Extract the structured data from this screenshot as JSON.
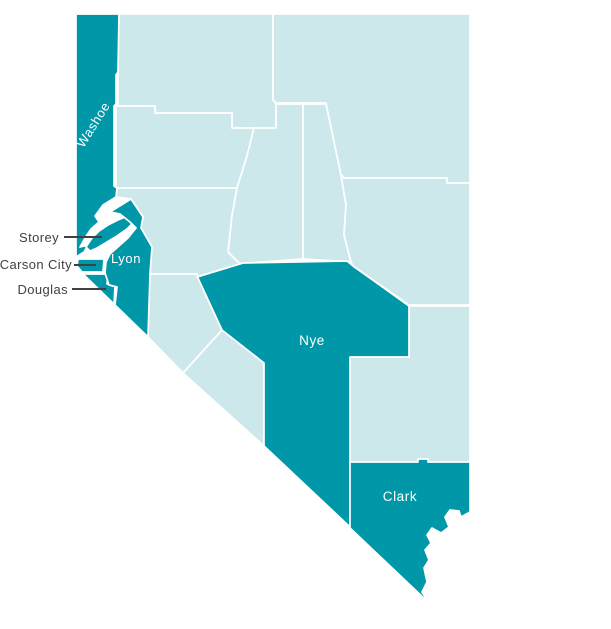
{
  "map": {
    "region": "Nevada",
    "colors": {
      "highlight": "#0097a9",
      "base": "#cde8eb",
      "border": "#ffffff",
      "inside_label": "#ffffff",
      "external_label": "#3e4042",
      "leader_line": "#3e4042",
      "background": "#ffffff"
    },
    "counties": [
      {
        "id": "humboldt",
        "name": "Humboldt",
        "highlighted": false
      },
      {
        "id": "elko",
        "name": "Elko",
        "highlighted": false
      },
      {
        "id": "pershing",
        "name": "Pershing",
        "highlighted": false
      },
      {
        "id": "lander",
        "name": "Lander",
        "highlighted": false
      },
      {
        "id": "eureka",
        "name": "Eureka",
        "highlighted": false
      },
      {
        "id": "white_pine",
        "name": "White Pine",
        "highlighted": false
      },
      {
        "id": "churchill",
        "name": "Churchill",
        "highlighted": false
      },
      {
        "id": "mineral",
        "name": "Mineral",
        "highlighted": false
      },
      {
        "id": "esmeralda",
        "name": "Esmeralda",
        "highlighted": false
      },
      {
        "id": "lincoln",
        "name": "Lincoln",
        "highlighted": false
      },
      {
        "id": "washoe",
        "name": "Washoe",
        "highlighted": true,
        "label": {
          "text": "Washoe",
          "placement": "inside",
          "x": 97,
          "y": 127,
          "rotation": -58,
          "font_size": 13
        }
      },
      {
        "id": "storey",
        "name": "Storey",
        "highlighted": true,
        "label": {
          "text": "Storey",
          "placement": "outside",
          "x": 59,
          "y": 242,
          "font_size": 13,
          "line": [
            64,
            237,
            102,
            237
          ]
        }
      },
      {
        "id": "carson_city",
        "name": "Carson City",
        "highlighted": true,
        "label": {
          "text": "Carson City",
          "placement": "outside",
          "x": 72,
          "y": 269,
          "font_size": 13,
          "line": [
            74,
            265,
            96,
            265
          ]
        }
      },
      {
        "id": "douglas",
        "name": "Douglas",
        "highlighted": true,
        "label": {
          "text": "Douglas",
          "placement": "outside",
          "x": 68,
          "y": 294,
          "font_size": 13,
          "line": [
            72,
            289,
            106,
            289
          ]
        }
      },
      {
        "id": "lyon",
        "name": "Lyon",
        "highlighted": true,
        "label": {
          "text": "Lyon",
          "placement": "inside",
          "x": 126,
          "y": 263,
          "rotation": 0,
          "font_size": 13
        }
      },
      {
        "id": "nye",
        "name": "Nye",
        "highlighted": true,
        "label": {
          "text": "Nye",
          "placement": "inside",
          "x": 312,
          "y": 345,
          "rotation": 0,
          "font_size": 13.5
        }
      },
      {
        "id": "clark",
        "name": "Clark",
        "highlighted": true,
        "label": {
          "text": "Clark",
          "placement": "inside",
          "x": 400,
          "y": 501,
          "rotation": 0,
          "font_size": 13.5
        }
      }
    ]
  }
}
